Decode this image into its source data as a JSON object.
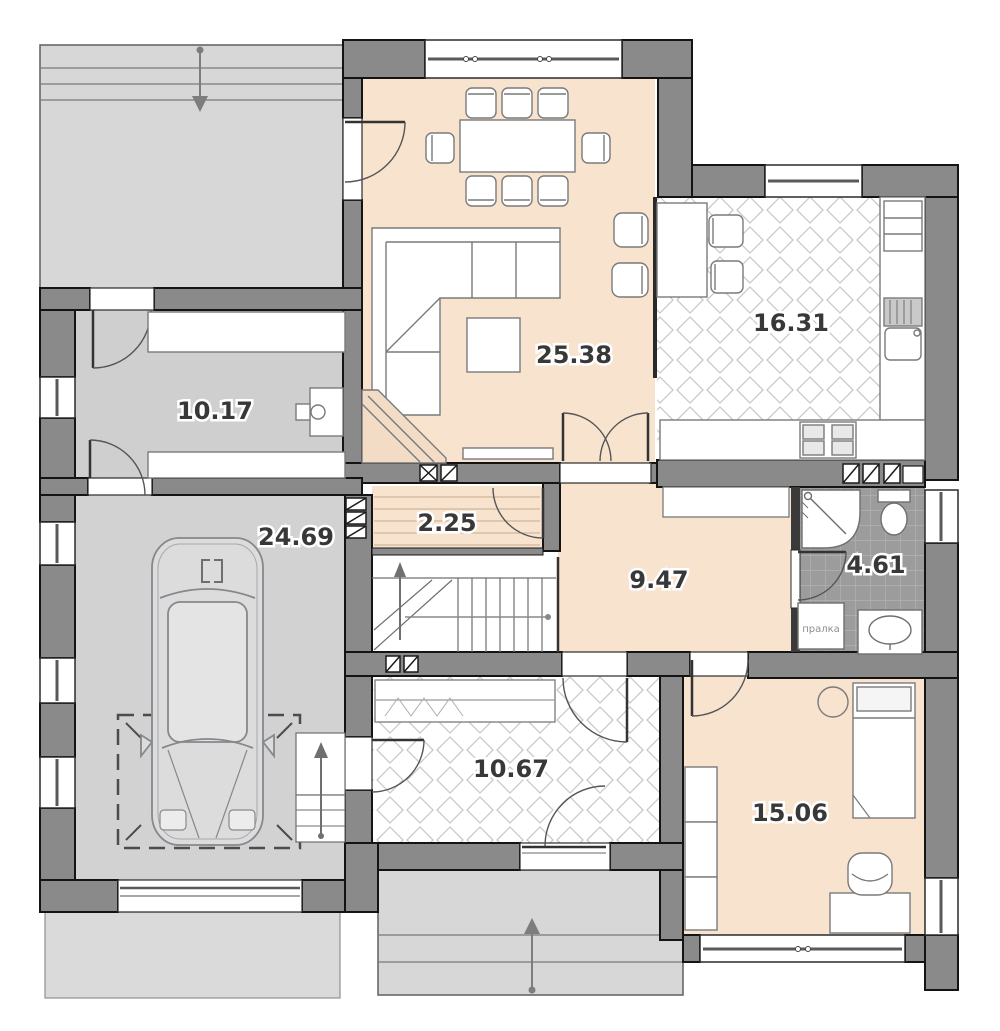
{
  "plan": {
    "title": "house-ground-floor-plan",
    "rooms": [
      {
        "id": "living-dining",
        "area_label": "25.38"
      },
      {
        "id": "kitchen",
        "area_label": "16.31"
      },
      {
        "id": "utility",
        "area_label": "10.17"
      },
      {
        "id": "garage",
        "area_label": "24.69"
      },
      {
        "id": "closet",
        "area_label": "2.25"
      },
      {
        "id": "hall",
        "area_label": "9.47"
      },
      {
        "id": "bathroom",
        "area_label": "4.61"
      },
      {
        "id": "entry-hall",
        "area_label": "10.67"
      },
      {
        "id": "bedroom",
        "area_label": "15.06"
      }
    ],
    "washer_label": "пралка",
    "colors": {
      "wall": "#8a8a8a",
      "wall_outline": "#141414",
      "floor_warm": "#f8e3cf",
      "floor_gray": "#d2d2d3",
      "terrace": "#d7d7d7",
      "bath_tile": "#9c9c9c",
      "tile_line": "#c9c9c9"
    }
  }
}
